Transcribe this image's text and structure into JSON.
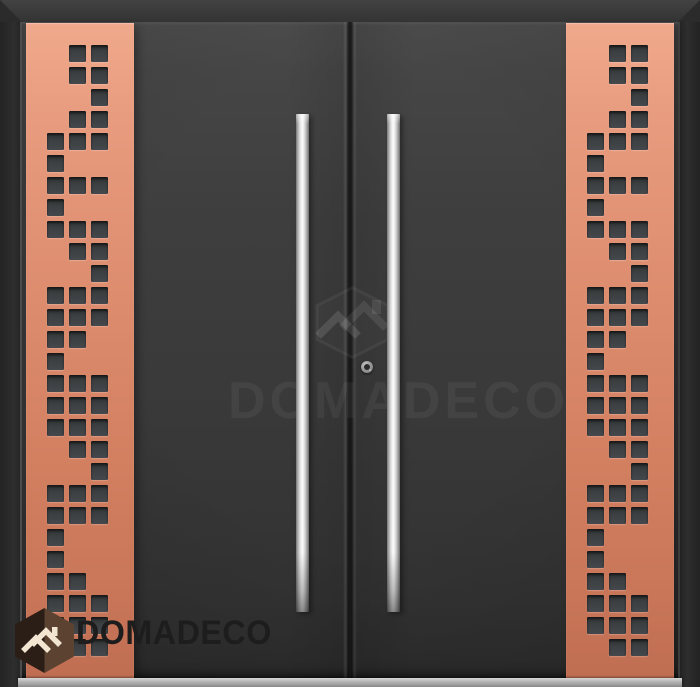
{
  "watermark": {
    "brand": "DOMADECO",
    "icons": [
      "hexagon-outline-icon",
      "roof-logo-icon"
    ]
  },
  "logo": {
    "brand": "DOMADECO",
    "icons": [
      "hexagon-badge-icon",
      "roof-logo-icon"
    ]
  },
  "door": {
    "panel_pattern_rows": [
      "011",
      "011",
      "001",
      "011",
      "111",
      "100",
      "111",
      "100",
      "111",
      "011",
      "001",
      "111",
      "111",
      "110",
      "100",
      "111",
      "111",
      "111",
      "011",
      "001",
      "111",
      "111",
      "100",
      "100",
      "110",
      "111",
      "111",
      "011"
    ],
    "colors": {
      "copper-top": "#f0a98c",
      "copper-mid": "#dd8c6e",
      "copper-bottom": "#c06e52",
      "door-gray": "#3b3b3b",
      "frame-gray": "#2c2c2c",
      "cutout-gray": "#3c3f41",
      "handle-steel": "#e9e9e9",
      "threshold-gray": "#b5b5b5",
      "logo-hex-dark": "#2b1e16",
      "logo-hex-light": "#5c4230",
      "logo-roof-cream": "#f2e6d3",
      "logo-text-dark": "#1d1d1d"
    }
  }
}
